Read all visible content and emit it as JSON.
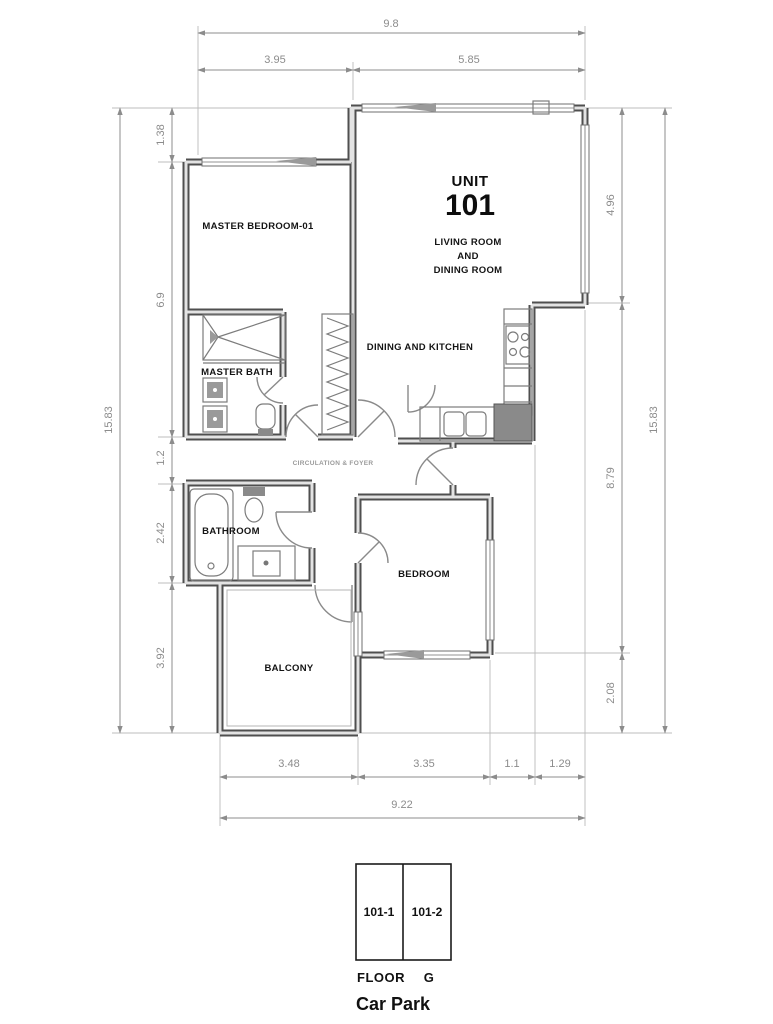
{
  "drawing": {
    "unit": {
      "label": "UNIT",
      "number": "101"
    },
    "rooms": {
      "master_bedroom": "MASTER BEDROOM-01",
      "master_bath": "MASTER BATH",
      "living_line1": "LIVING ROOM",
      "living_line2": "AND",
      "living_line3": "DINING ROOM",
      "dining_kitchen": "DINING AND KITCHEN",
      "circulation": "CIRCULATION & FOYER",
      "bathroom": "BATHROOM",
      "bedroom": "BEDROOM",
      "balcony": "BALCONY"
    },
    "dimensions": {
      "top_total": "9.8",
      "top_segments": [
        "3.95",
        "5.85"
      ],
      "left_total": "15.83",
      "left_segments": [
        "1.38",
        "6.9",
        "1.2",
        "2.42",
        "3.92"
      ],
      "right_segments": [
        "4.96",
        "8.79",
        "2.08"
      ],
      "right_total": "15.83",
      "bottom_segments": [
        "3.48",
        "3.35",
        "1.1",
        "1.29"
      ],
      "bottom_total": "9.22"
    },
    "car_park": {
      "stalls": [
        "101-1",
        "101-2"
      ],
      "floor_label": "FLOOR",
      "floor_value": "G",
      "title": "Car Park"
    },
    "colors": {
      "wall": "#4f4f4f",
      "dimension": "#8c8c8c",
      "label": "#141414"
    }
  }
}
